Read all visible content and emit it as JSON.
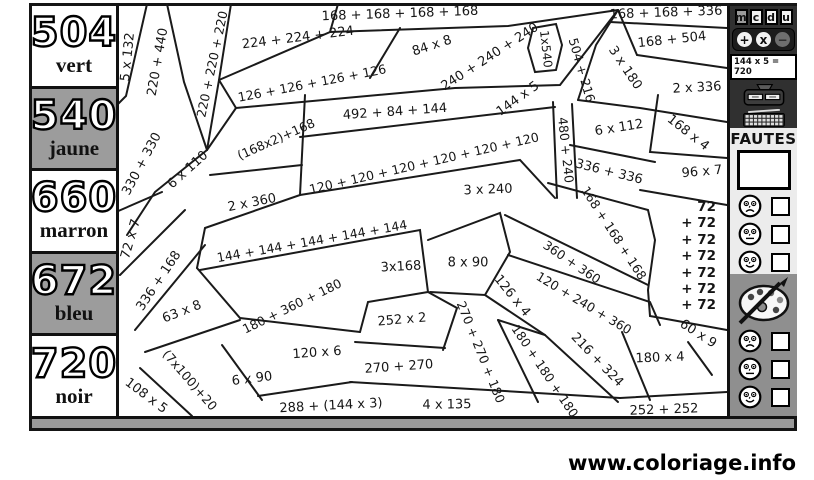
{
  "title": "Coloriage magique multiplications et additions",
  "colors": {
    "legend_gray": "#9c9c9c",
    "band_gray": "#9a9a9a",
    "panel_dark": "#303030",
    "section_light": "#ececec",
    "section_gray": "#8f8f8f",
    "line_black": "#1a1a1a"
  },
  "legend": {
    "items": [
      {
        "value": "504",
        "color_name": "vert",
        "bg": "white"
      },
      {
        "value": "540",
        "color_name": "jaune",
        "bg": "gray"
      },
      {
        "value": "660",
        "color_name": "marron",
        "bg": "white"
      },
      {
        "value": "672",
        "color_name": "bleu",
        "bg": "gray"
      },
      {
        "value": "720",
        "color_name": "noir",
        "bg": "white"
      }
    ]
  },
  "puzzle": {
    "expressions": [
      {
        "t": "5 x 132",
        "x": 128,
        "y": 57,
        "r": -84
      },
      {
        "t": "220 + 440",
        "x": 158,
        "y": 62,
        "r": -80
      },
      {
        "t": "220 + 220 + 220",
        "x": 212,
        "y": 64,
        "r": -78,
        "fs": 12.5
      },
      {
        "t": "224 + 224 + 224",
        "x": 298,
        "y": 38,
        "r": -7
      },
      {
        "t": "168 + 168 + 168 + 168",
        "x": 400,
        "y": 14,
        "r": -2
      },
      {
        "t": "168 + 168 + 336",
        "x": 666,
        "y": 13,
        "r": -2
      },
      {
        "t": "126 + 126 + 126 + 126",
        "x": 312,
        "y": 83,
        "r": -11,
        "fs": 12.5
      },
      {
        "t": "84 x 8",
        "x": 432,
        "y": 46,
        "r": -18
      },
      {
        "t": "240 + 240 + 240",
        "x": 490,
        "y": 57,
        "r": -33
      },
      {
        "t": "1x540",
        "x": 546,
        "y": 49,
        "r": 84,
        "fs": 12
      },
      {
        "t": "504 + 216",
        "x": 582,
        "y": 70,
        "r": 74,
        "fs": 12.5
      },
      {
        "t": "3 x 180",
        "x": 625,
        "y": 68,
        "r": 56
      },
      {
        "t": "168 + 504",
        "x": 672,
        "y": 40,
        "r": -6
      },
      {
        "t": "2 x 336",
        "x": 697,
        "y": 88,
        "r": -3
      },
      {
        "t": "144 x 5",
        "x": 518,
        "y": 99,
        "r": -36
      },
      {
        "t": "492 + 84 + 144",
        "x": 395,
        "y": 112,
        "r": -4
      },
      {
        "t": "6 x 112",
        "x": 619,
        "y": 128,
        "r": -9
      },
      {
        "t": "168 x 4",
        "x": 688,
        "y": 133,
        "r": 38
      },
      {
        "t": "96 x 7",
        "x": 702,
        "y": 172,
        "r": -5
      },
      {
        "t": "(168x2)+168",
        "x": 276,
        "y": 139,
        "r": -24,
        "fs": 12.5
      },
      {
        "t": "330 + 330",
        "x": 142,
        "y": 164,
        "r": -62
      },
      {
        "t": "6 x 110",
        "x": 188,
        "y": 170,
        "r": -42
      },
      {
        "t": "2 x 360",
        "x": 252,
        "y": 203,
        "r": -11
      },
      {
        "t": "120 + 120 + 120 + 120 + 120 + 120",
        "x": 424,
        "y": 163,
        "r": -13,
        "fs": 12.5
      },
      {
        "t": "3 x 240",
        "x": 488,
        "y": 190,
        "r": -2
      },
      {
        "t": "336 + 336",
        "x": 609,
        "y": 172,
        "r": 14
      },
      {
        "t": "480 + 240",
        "x": 566,
        "y": 150,
        "r": 84,
        "fs": 12.5
      },
      {
        "t": "168 + 168 + 168",
        "x": 614,
        "y": 233,
        "r": 57,
        "fs": 12.5
      },
      {
        "t": "144 + 144 + 144 + 144 + 144",
        "x": 312,
        "y": 241,
        "r": -10,
        "fs": 12.5
      },
      {
        "t": "72 x 7",
        "x": 131,
        "y": 239,
        "r": -74
      },
      {
        "t": "336 + 168",
        "x": 159,
        "y": 281,
        "r": -56
      },
      {
        "t": "63 x 8",
        "x": 182,
        "y": 312,
        "r": -21
      },
      {
        "t": "3x168",
        "x": 401,
        "y": 267,
        "r": -3
      },
      {
        "t": "8 x 90",
        "x": 468,
        "y": 263,
        "r": 0
      },
      {
        "t": "360 + 360",
        "x": 572,
        "y": 262,
        "r": 34,
        "fs": 12.5
      },
      {
        "t": "120 + 240 + 360",
        "x": 584,
        "y": 303,
        "r": 31,
        "fs": 12.5
      },
      {
        "t": "126 x 4",
        "x": 512,
        "y": 296,
        "r": 51
      },
      {
        "t": "180 + 360 + 180",
        "x": 292,
        "y": 306,
        "r": -26,
        "fs": 12.5
      },
      {
        "t": "252 x 2",
        "x": 402,
        "y": 320,
        "r": -5
      },
      {
        "t": "60 x 9",
        "x": 698,
        "y": 334,
        "r": 33
      },
      {
        "t": "216 + 324",
        "x": 597,
        "y": 360,
        "r": 46
      },
      {
        "t": "180 x 4",
        "x": 660,
        "y": 358,
        "r": -2
      },
      {
        "t": "270 + 270",
        "x": 399,
        "y": 367,
        "r": -4
      },
      {
        "t": "270 + 270 + 180",
        "x": 481,
        "y": 352,
        "r": 68,
        "fs": 12.5
      },
      {
        "t": "180 + 180 + 180",
        "x": 545,
        "y": 371,
        "r": 56,
        "fs": 12.5
      },
      {
        "t": "(7x100)+20",
        "x": 190,
        "y": 380,
        "r": 49,
        "fs": 12.5
      },
      {
        "t": "120 x 6",
        "x": 317,
        "y": 353,
        "r": -4
      },
      {
        "t": "6 x 90",
        "x": 252,
        "y": 379,
        "r": -7
      },
      {
        "t": "108 x 5",
        "x": 146,
        "y": 396,
        "r": 37
      },
      {
        "t": "288 + (144 x 3)",
        "x": 331,
        "y": 406,
        "r": -3
      },
      {
        "t": "4 x 135",
        "x": 447,
        "y": 405,
        "r": -1
      },
      {
        "t": "252 + 252",
        "x": 664,
        "y": 410,
        "r": -2
      }
    ],
    "sum_column_lines": [
      "72",
      "+ 72",
      "+ 72",
      "+ 72",
      "+ 72",
      "+ 72",
      "+ 72"
    ]
  },
  "sidebar": {
    "place_value_tiles": [
      "m",
      "c",
      "d",
      "u"
    ],
    "operators": [
      "+",
      "x",
      "−"
    ],
    "display": "144 x 5 = 720",
    "fautes_label": "FAUTES",
    "faces": [
      "sad",
      "neutral",
      "happy"
    ]
  },
  "footer": {
    "website": "www.coloriage.info"
  }
}
